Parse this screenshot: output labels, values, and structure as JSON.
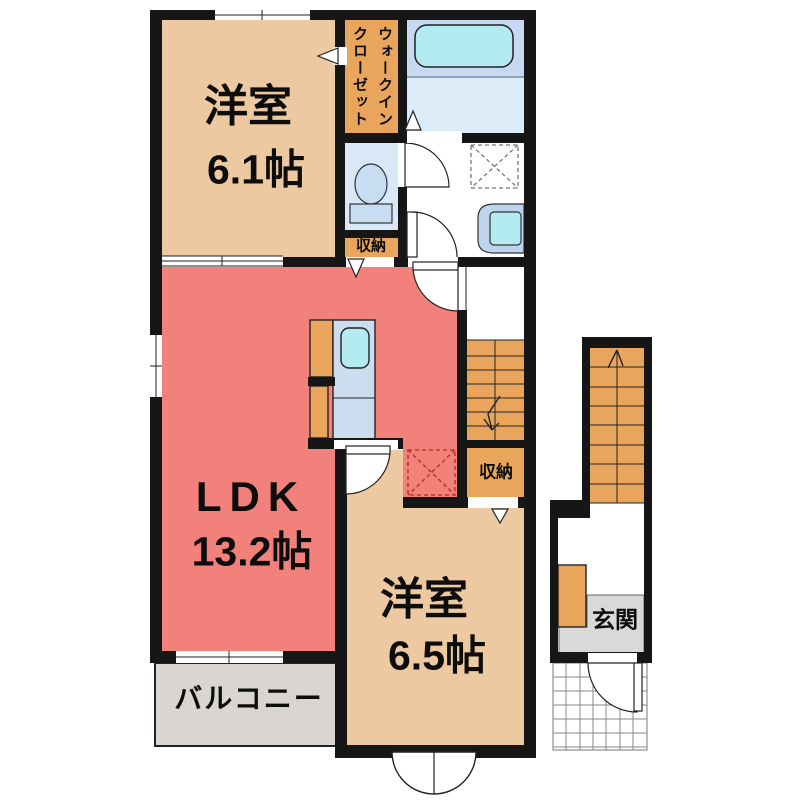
{
  "title": "apartment-floor-plan",
  "colors": {
    "wall": "#161616",
    "room_beige": "#ecc9a0",
    "room_red": "#f2817c",
    "accent_orange": "#e9a55c",
    "toilet_blue": "#d9e8f7",
    "bath_blue": "#c6d9f1",
    "bath_floor": "#dcebf8",
    "fixture_cyan": "#b4ebf2",
    "fixture_blue": "#c9ddf2",
    "basin_blue": "#bcd5ec",
    "counter_blue": "#ccddf0",
    "balcony_gray": "#d9d5d0",
    "genkan_gray": "#d9d9d9",
    "fridge_dash_red": "#c0392b",
    "text": "#0d0d0d"
  },
  "rooms": {
    "western1": {
      "name": "洋室",
      "size": "6.1帖"
    },
    "ldk": {
      "name": "LDK",
      "size": "13.2帖"
    },
    "western2": {
      "name": "洋室",
      "size": "6.5帖"
    },
    "balcony": {
      "label": "バルコニー"
    },
    "walk_in_closet": {
      "label_line1": "ウォークイン",
      "label_line2": "クローゼット"
    },
    "storage_top": {
      "label": "収納"
    },
    "storage_right": {
      "label": "収納"
    },
    "entrance": {
      "label": "玄関"
    }
  }
}
